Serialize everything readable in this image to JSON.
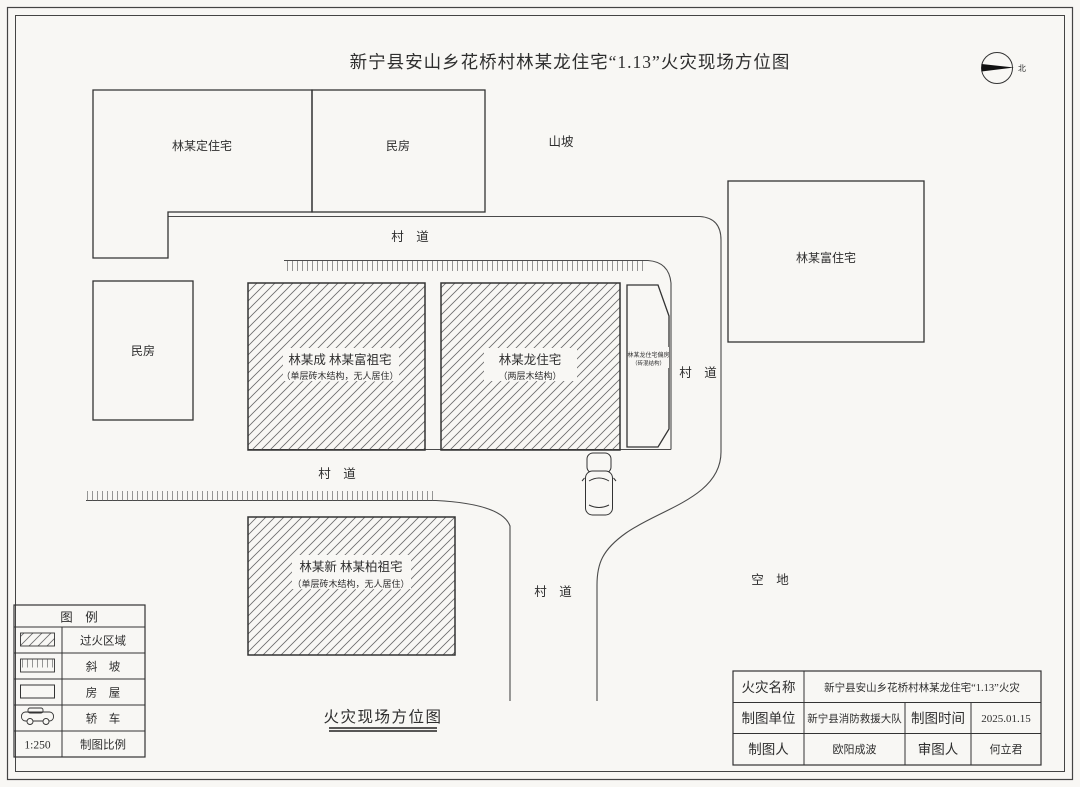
{
  "title": "新宁县安山乡花桥村林某龙住宅“1.13”火灾现场方位图",
  "caption": "火灾现场方位图",
  "compass": {
    "north_label": "北"
  },
  "map_labels": {
    "hillside": "山坡",
    "open_space": "空　地",
    "road_top": "村　道",
    "road_middle": "村　道",
    "road_right": "村　道",
    "road_bottom": "村　道"
  },
  "buildings": {
    "lin_ding": {
      "label": "林某定住宅"
    },
    "minfang_top": {
      "label": "民房"
    },
    "lin_fu": {
      "label": "林某富住宅"
    },
    "minfang_left": {
      "label": "民房"
    },
    "cheng_fu_zuzhai": {
      "label": "林某成 林某富祖宅",
      "sublabel": "（单层砖木结构，无人居住）"
    },
    "lin_long": {
      "label": "林某龙住宅",
      "sublabel": "（两层木结构）"
    },
    "lin_long_annex": {
      "label": "林某龙住宅偏房",
      "sublabel": "（砖混结构）"
    },
    "xin_bai_zuzhai": {
      "label": "林某新 林某柏祖宅",
      "sublabel": "（单层砖木结构，无人居住）"
    }
  },
  "legend": {
    "header": "图　例",
    "scale_value": "1:250",
    "items": [
      {
        "symbol": "burned-area-swatch",
        "label": "过火区域"
      },
      {
        "symbol": "slope-swatch",
        "label": "斜　坡"
      },
      {
        "symbol": "house-swatch",
        "label": "房　屋"
      },
      {
        "symbol": "car-swatch",
        "label": "轿　车"
      },
      {
        "symbol": "scale-text",
        "label": "制图比例"
      }
    ]
  },
  "title_block": {
    "fire_name_label": "火灾名称",
    "fire_name_value": "新宁县安山乡花桥村林某龙住宅“1.13”火灾",
    "drafting_unit_label": "制图单位",
    "drafting_unit_value": "新宁县消防救援大队",
    "drafting_time_label": "制图时间",
    "drafting_time_value": "2025.01.15",
    "drafter_label": "制图人",
    "drafter_value": "欧阳成波",
    "reviewer_label": "审图人",
    "reviewer_value": "何立君"
  },
  "colors": {
    "line": "#4a4a4a",
    "hatch": "#6a6a6a",
    "text": "#2e2e2e",
    "background": "#f8f7f4"
  }
}
